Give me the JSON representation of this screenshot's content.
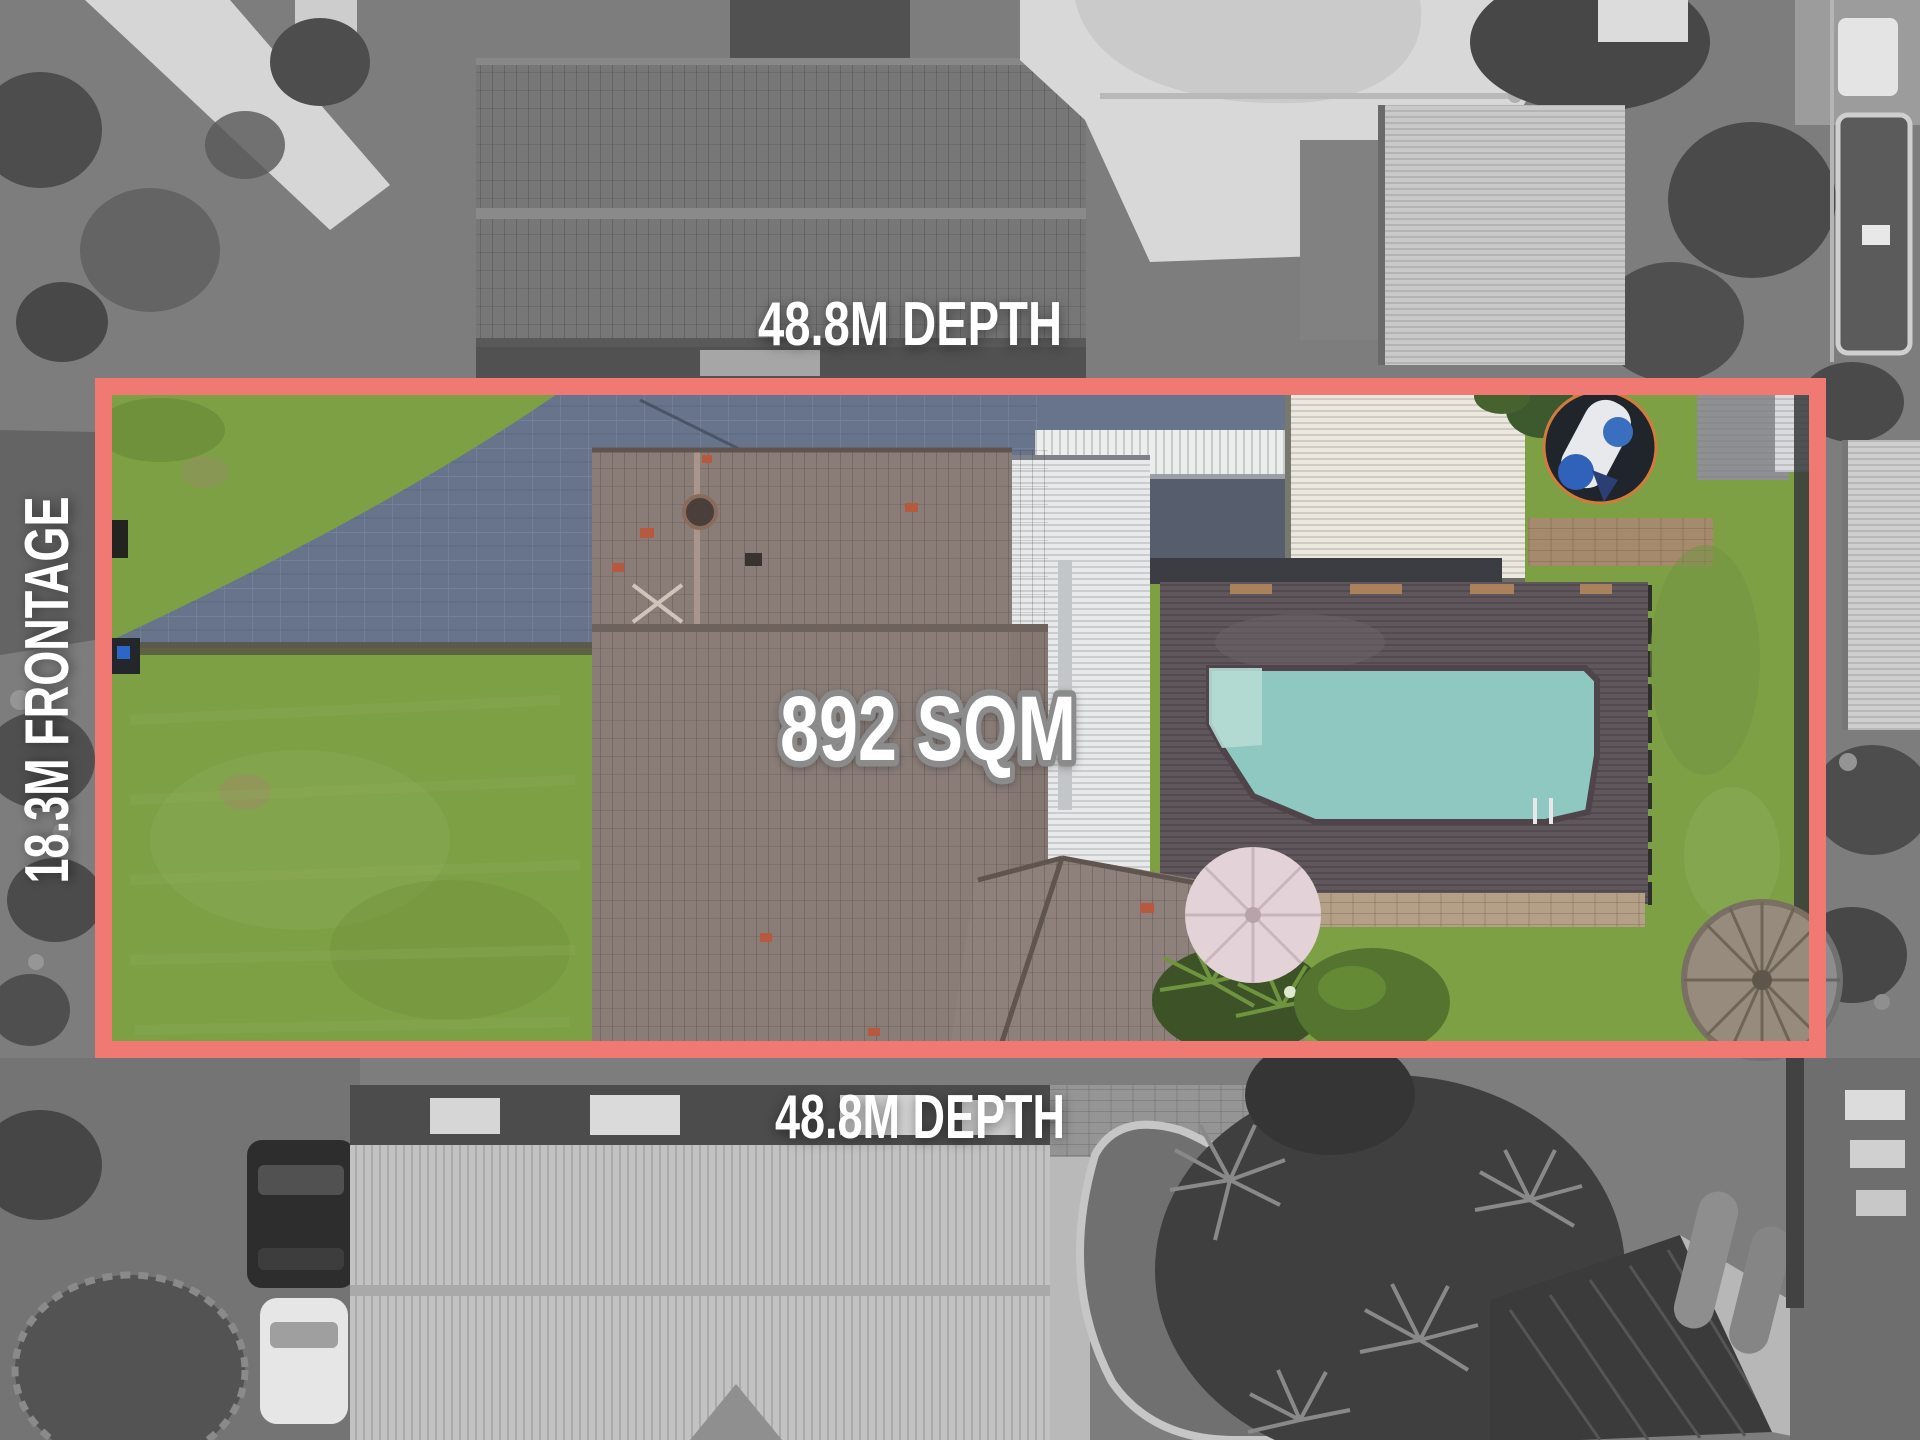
{
  "annotations": {
    "depth_top": "48.8M DEPTH",
    "depth_bottom": "48.8M DEPTH",
    "frontage": "18.3M FRONTAGE",
    "area": "892 SQM"
  },
  "colors": {
    "boundary": "#f07a73",
    "label_text": "#ffffff",
    "area_outline": "#8b8b8b",
    "pool_water": "#8fc8c0",
    "lawn": "#7da045",
    "driveway": "#68748c"
  },
  "scene_features": [
    "front-lawn",
    "paved-driveway",
    "main-house-tiled-roof",
    "white-garage-roofs",
    "timber-pool-deck",
    "swimming-pool",
    "spa-trampoline",
    "pink-umbrella",
    "thatch-gazebo",
    "backyard-lawn",
    "grayscale-neighbouring-properties"
  ]
}
